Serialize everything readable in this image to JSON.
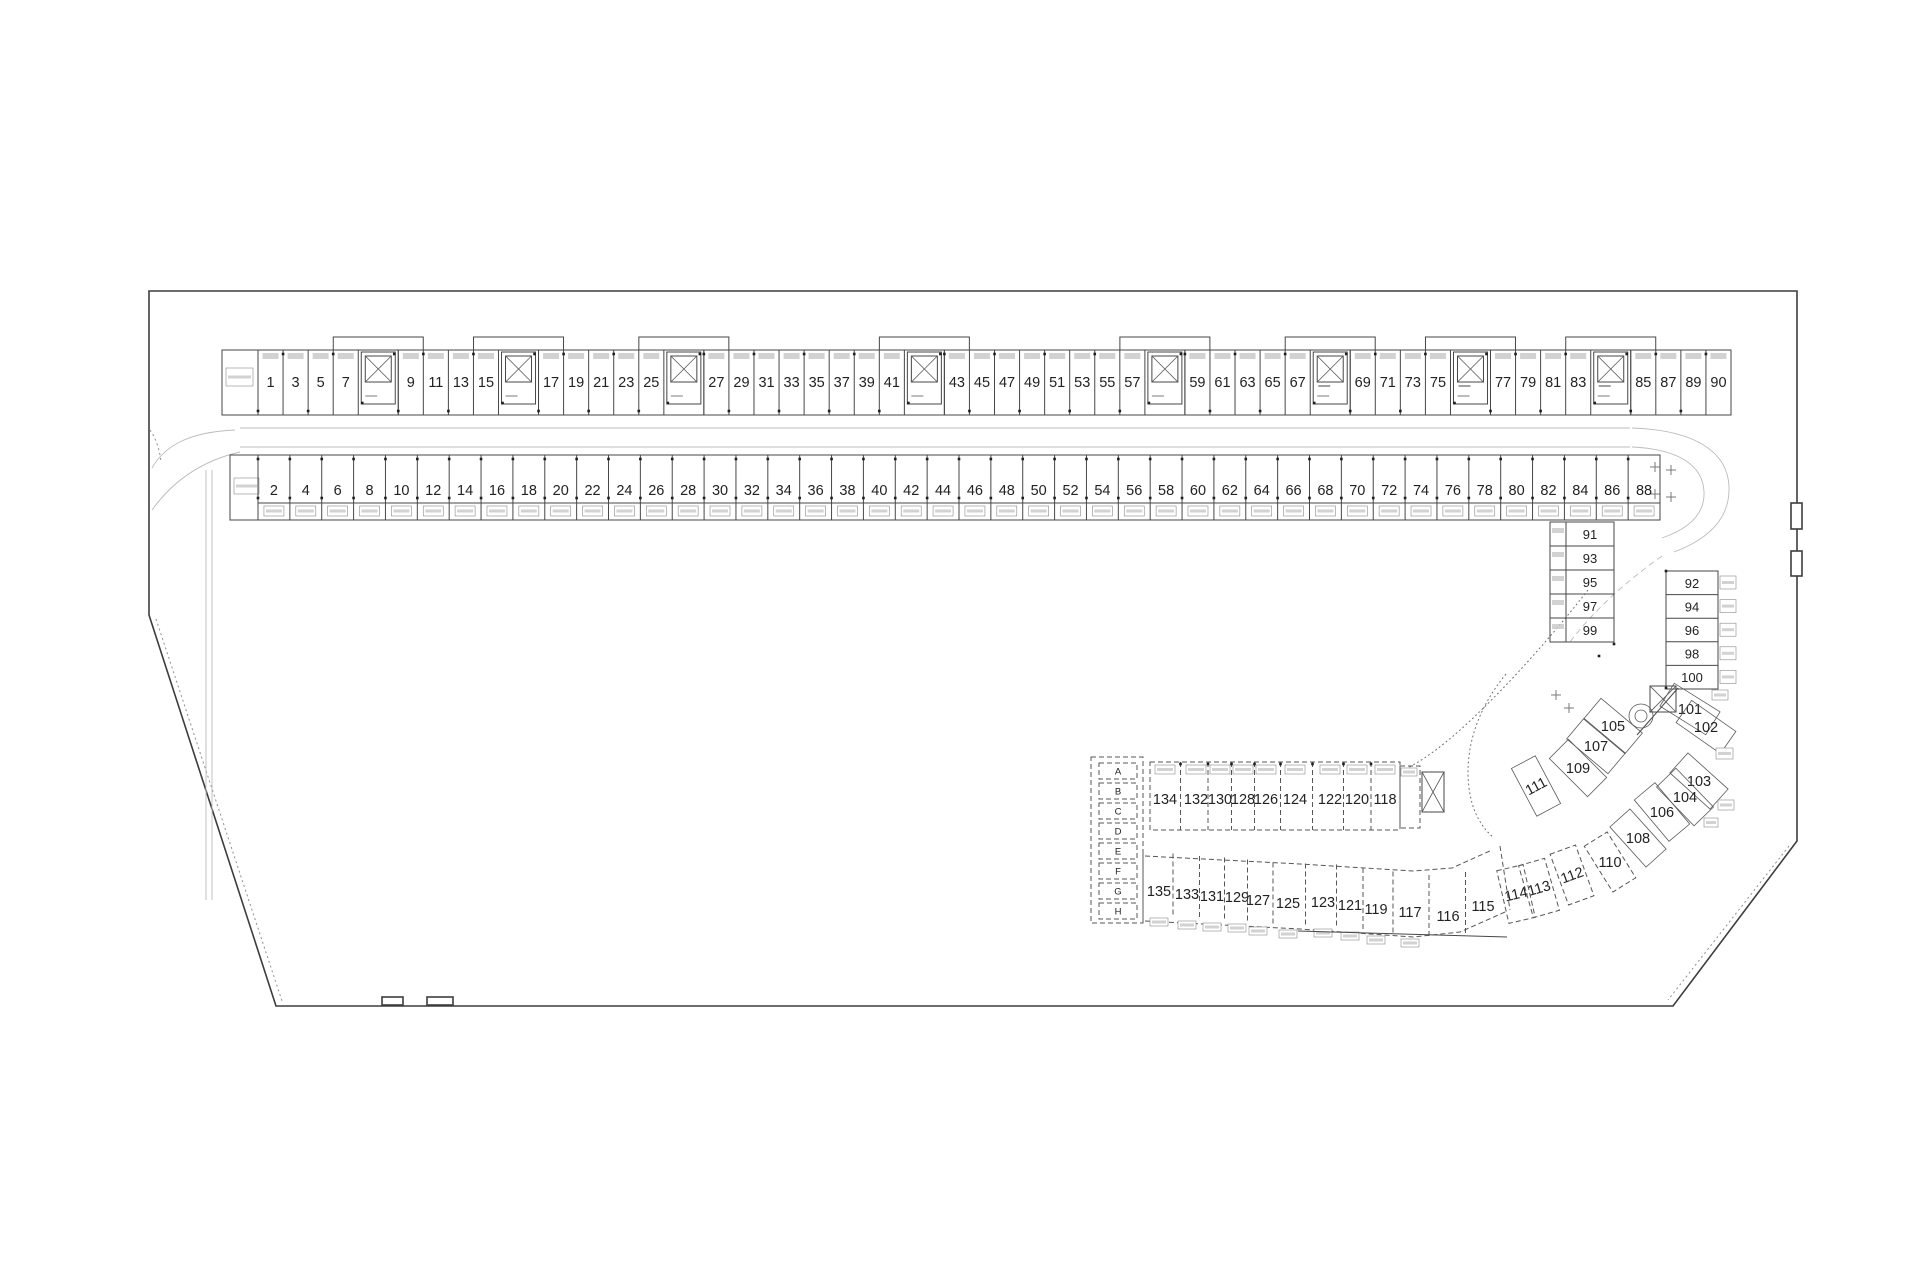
{
  "plan": {
    "kind": "parking-level-floor-plan",
    "colors": {
      "background": "#ffffff",
      "ink": "#474747",
      "text": "#222222",
      "faint": "#bcbcbc"
    },
    "tokens": {
      "S": "stair-shaft",
      "SD": "stair-shaft-with-dash-marker",
      "dash_marker": "—"
    },
    "north_row": {
      "sequence": [
        "1",
        "3",
        "5",
        "7",
        "S",
        "9",
        "11",
        "13",
        "15",
        "S",
        "17",
        "19",
        "21",
        "23",
        "25",
        "S",
        "27",
        "29",
        "31",
        "33",
        "35",
        "37",
        "39",
        "41",
        "S",
        "43",
        "45",
        "47",
        "49",
        "51",
        "53",
        "55",
        "57",
        "S",
        "59",
        "61",
        "63",
        "65",
        "67",
        "SD",
        "69",
        "71",
        "73",
        "75",
        "SD",
        "77",
        "79",
        "81",
        "83",
        "SD",
        "85",
        "87",
        "89",
        "90"
      ]
    },
    "south_row": {
      "stalls": [
        "2",
        "4",
        "6",
        "8",
        "10",
        "12",
        "14",
        "16",
        "18",
        "20",
        "22",
        "24",
        "26",
        "28",
        "30",
        "32",
        "34",
        "36",
        "38",
        "40",
        "42",
        "44",
        "46",
        "48",
        "50",
        "52",
        "54",
        "56",
        "58",
        "60",
        "62",
        "64",
        "66",
        "68",
        "70",
        "72",
        "74",
        "76",
        "78",
        "80",
        "82",
        "84",
        "86",
        "88"
      ]
    },
    "east_inner_column": {
      "stalls": [
        "91",
        "93",
        "95",
        "97",
        "99"
      ]
    },
    "east_outer_column": {
      "stalls": [
        "92",
        "94",
        "96",
        "98",
        "100"
      ]
    },
    "diagonal_row_outer": {
      "stalls": [
        "101",
        "102",
        "103",
        "104",
        "106",
        "108",
        "110",
        "112",
        "113",
        "114"
      ]
    },
    "diagonal_row_inner": {
      "stalls": [
        "105",
        "107",
        "109",
        "111"
      ]
    },
    "south_cluster": {
      "letter_column": [
        "A",
        "B",
        "C",
        "D",
        "E",
        "F",
        "G",
        "H"
      ],
      "upper_row": [
        "134",
        "132",
        "130",
        "128",
        "126",
        "124",
        "122",
        "120",
        "118"
      ],
      "lower_row": [
        "135",
        "133",
        "131",
        "129",
        "127",
        "125",
        "123",
        "121",
        "119",
        "117",
        "116",
        "115"
      ]
    }
  }
}
